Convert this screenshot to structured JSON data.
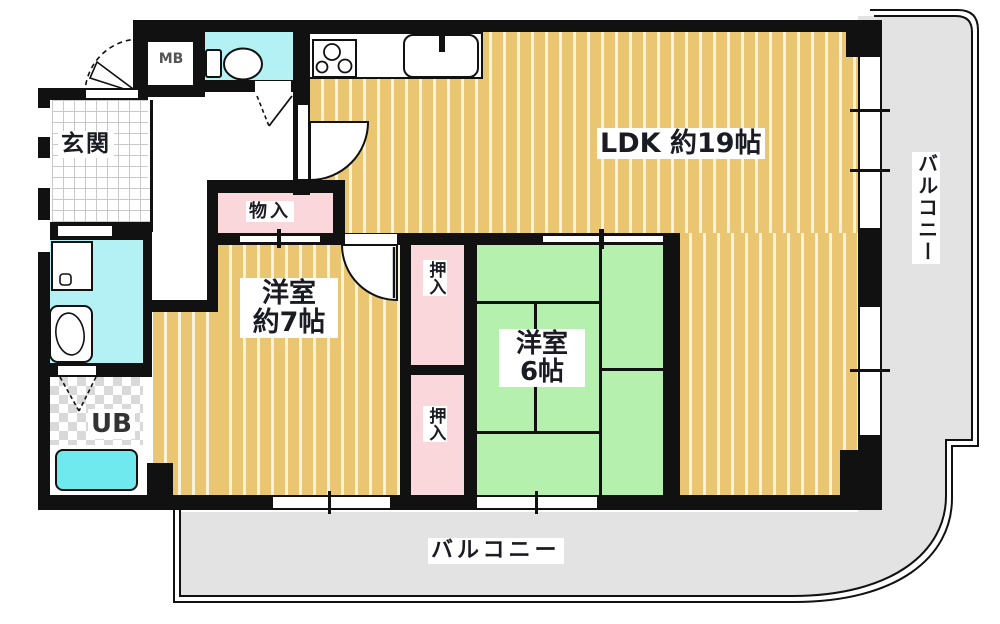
{
  "rooms": {
    "ldk": {
      "label": "LDK 約19帖"
    },
    "entrance": {
      "label": "玄関"
    },
    "meter_box": {
      "label": "MB"
    },
    "storage": {
      "label": "物入"
    },
    "western7": {
      "line1": "洋室",
      "line2": "約7帖"
    },
    "western6": {
      "line1": "洋室",
      "line2": "6帖"
    },
    "closet_upper": {
      "label": "押入"
    },
    "closet_lower": {
      "label": "押入"
    },
    "unit_bath": {
      "label": "UB"
    },
    "balcony_right": {
      "label": "バルコニー"
    },
    "balcony_bottom": {
      "label": "バルコニー"
    }
  },
  "icons": [
    "toilet-icon",
    "stove-icon",
    "sink-icon",
    "faucet-icon",
    "washbasin-icon",
    "washing-machine-icon",
    "bathtub-icon",
    "door-swing-arc",
    "folding-door-icon",
    "sliding-door-icon",
    "window-icon"
  ],
  "colors": {
    "wall": "#111111",
    "wood_floor": "#eac572",
    "wood_stripe": "#f9f2dc",
    "tatami_green": "#b5f0ae",
    "closet_pink": "#f9d7da",
    "water_cyan": "#b4f1f4",
    "bathtub_cyan": "#70e9ee",
    "balcony_gray": "#e3e3e3",
    "tile_gray": "#d9d9d9",
    "text_dark": "#1b1b24",
    "text_gray": "#555555"
  }
}
